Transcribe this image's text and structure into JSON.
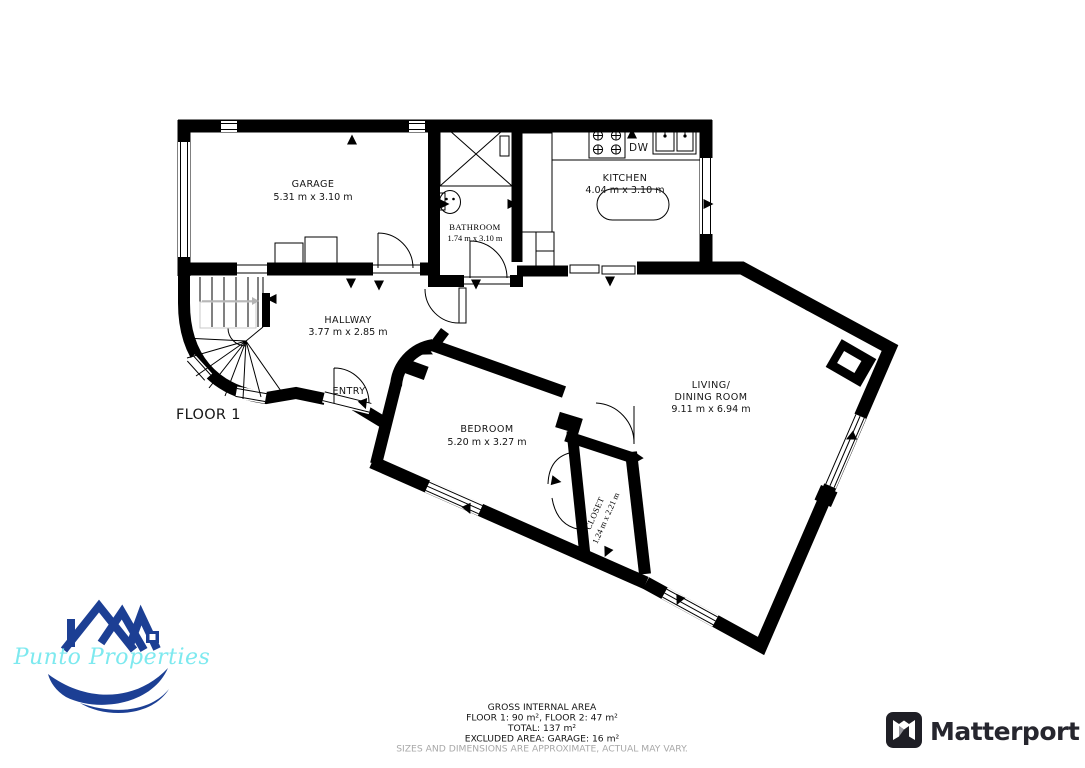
{
  "floor_plan": {
    "floor_label": "FLOOR 1",
    "rooms": {
      "garage": {
        "name": "GARAGE",
        "dims": "5.31 m x 3.10 m"
      },
      "bathroom": {
        "name": "BATHROOM",
        "dims": "1.74 m x 3.10 m"
      },
      "kitchen": {
        "name": "KITCHEN",
        "dims": "4.04 m x 3.10 m"
      },
      "hallway": {
        "name": "HALLWAY",
        "dims": "3.77 m x 2.85 m"
      },
      "entry": {
        "name": "ENTRY"
      },
      "living_dining": {
        "name_line1": "LIVING/",
        "name_line2": "DINING ROOM",
        "dims": "9.11 m x 6.94 m"
      },
      "bedroom": {
        "name": "BEDROOM",
        "dims": "5.20 m x 3.27 m"
      },
      "closet": {
        "name": "CLOSET",
        "dims": "1.24 m x 2.21 m"
      }
    },
    "appliance_labels": {
      "dishwasher": "DW"
    }
  },
  "footer": {
    "title": "GROSS INTERNAL AREA",
    "floor_areas": "FLOOR 1: 90 m², FLOOR 2: 47 m²",
    "total": "TOTAL: 137 m²",
    "excluded": "EXCLUDED AREA: GARAGE: 16 m²",
    "disclaimer": "SIZES AND DIMENSIONS ARE APPROXIMATE, ACTUAL MAY VARY."
  },
  "branding": {
    "agency": {
      "name": "Punto Properties",
      "logo_blue": "#1c3f94",
      "name_color": "#7de9ef"
    },
    "provider": {
      "name": "Matterport",
      "logo_color": "#26262e"
    }
  }
}
